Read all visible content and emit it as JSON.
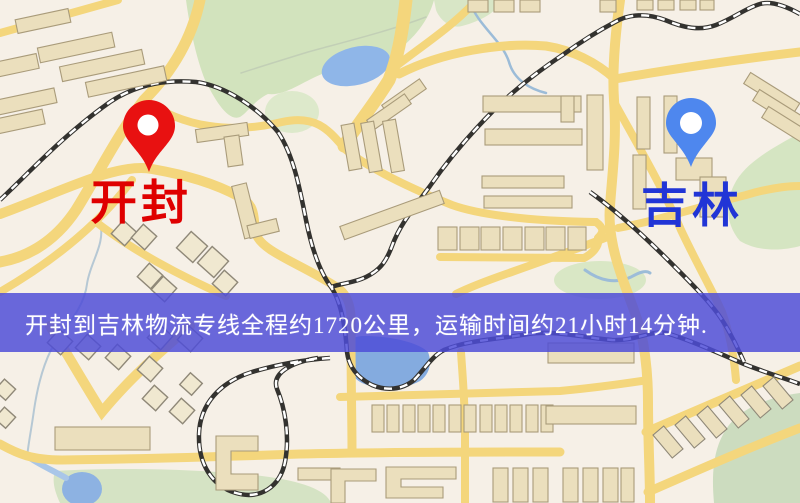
{
  "app": {
    "view": "map-route-overview"
  },
  "banner": {
    "text": "开封到吉林物流专线全程约1720公里，运输时间约21小时14分钟.",
    "bg_color": "#4d4cd8",
    "text_color": "#ffffff"
  },
  "route_info": {
    "origin": "开封",
    "destination": "吉林",
    "service": "物流专线",
    "distance": "约1720公里",
    "duration": "约21小时14分钟"
  },
  "markers": {
    "origin": {
      "label": "开封",
      "pin_color": "#e81111",
      "label_color": "#df0000"
    },
    "destination": {
      "label": "吉林",
      "pin_color": "#4e87ee",
      "label_color": "#2135d6"
    }
  },
  "palette": {
    "map_background": "#f6f0e7",
    "road_yellow": "#f4d67c",
    "park_green": "#d2e3bd",
    "water_blue": "#8fb6e8",
    "building_tan": "#ebdfbd",
    "railway_black": "#33322f",
    "banner_blue": "#4d4cd8"
  }
}
